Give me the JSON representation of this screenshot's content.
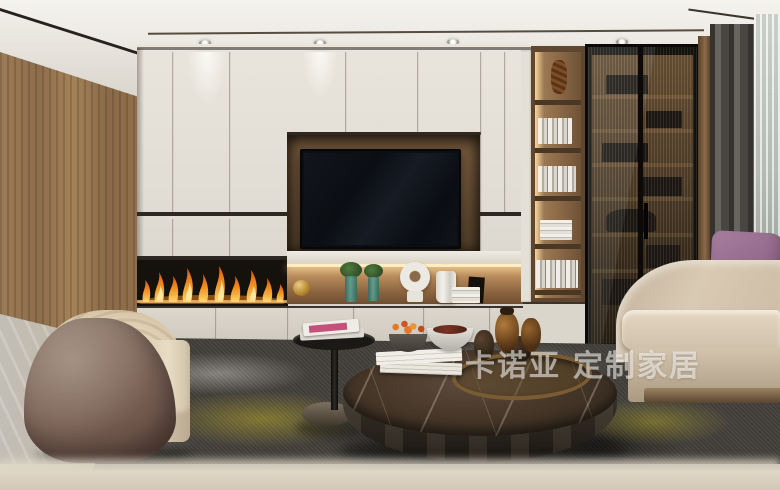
{
  "scene": {
    "title": "modern-living-room-render",
    "watermark": {
      "brand": "卡诺亚",
      "tagline": "定制家居",
      "full_text": "卡诺亚 定制家居",
      "color": "#ffffff",
      "opacity": 0.55
    }
  },
  "palette": {
    "ceiling": "#f2efe9",
    "cabinet_panel": "#e3dfd6",
    "wood_wall": "#94744f",
    "tv_niche_wood": "#6b5138",
    "tv_screen": "#0d1014",
    "flame_orange": "#ff9a26",
    "flame_yellow": "#ffdf6e",
    "glass_cabinet": "#17140f",
    "curtain_dark": "#56524e",
    "curtain_sheer": "#ccd1cb",
    "sofa": "#d4c5af",
    "pillow_purple": "#8f6487",
    "armchair_shell": "#7d665a",
    "armchair_fabric": "#e6dac2",
    "coffee_table_marble": "#44362a",
    "coffee_table_body": "#2a241c",
    "side_table": "#1b1916",
    "rug_base": "#44413c",
    "rug_yellow": "#b4a52c",
    "floor_wood": "#b3a089",
    "floor_stone": "#c6c2ba",
    "led_warm": "#ffedc4"
  },
  "objects": {
    "tv": "wall-mounted television",
    "fireplace": "linear fireplace with flames",
    "decor_shelf": "lit display niche with vases and plants",
    "bookshelf": "open wood shelving with books",
    "glass_cabinet": "smoked fluted-glass display cabinet",
    "sofa": "beige fabric sofa",
    "pillow": "purple accent pillow",
    "armchair": "curved suede barrel armchair",
    "coffee_table": "round dark-marble coffee table",
    "side_table": "black pedestal side table with magazines",
    "rug": "charcoal abstract rug with yellow accents",
    "curtains": "grey blackout curtain with sheer"
  }
}
